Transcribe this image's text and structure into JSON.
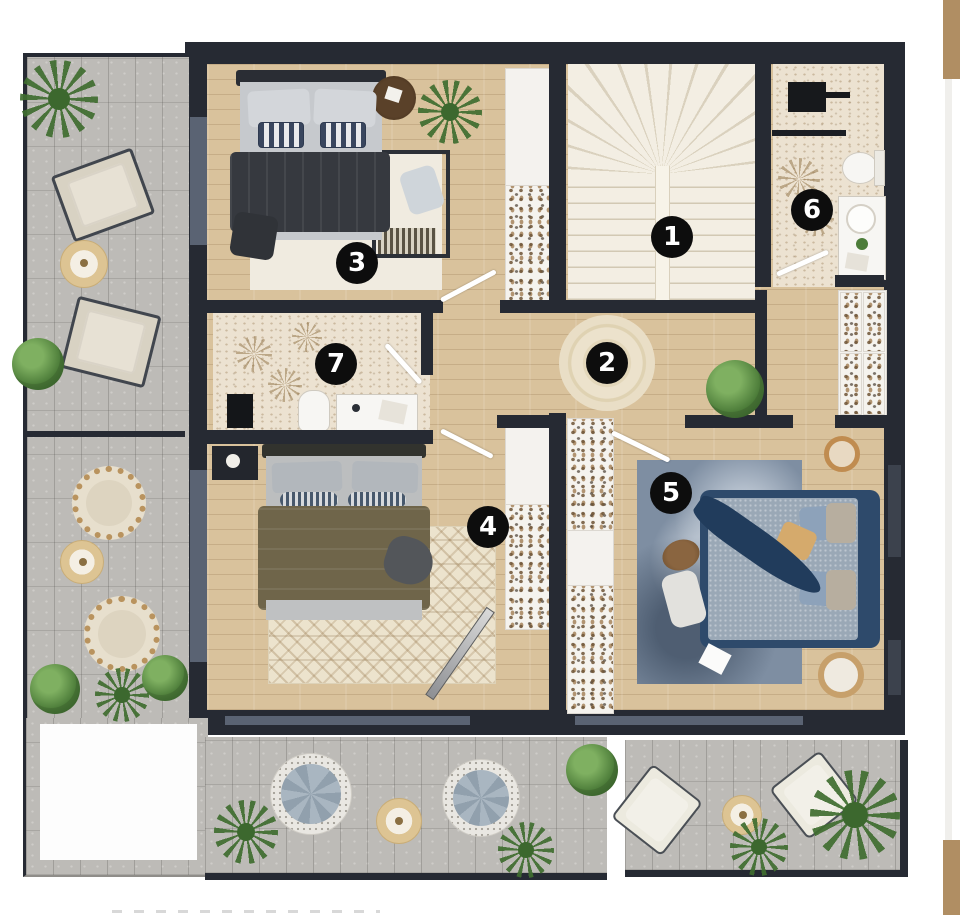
{
  "room_badges": [
    {
      "label": "1"
    },
    {
      "label": "2"
    },
    {
      "label": "3"
    },
    {
      "label": "4"
    },
    {
      "label": "5"
    },
    {
      "label": "6"
    },
    {
      "label": "7"
    }
  ],
  "theme": {
    "wall": "#262a33",
    "wood": "#d9c29c",
    "terrace": "#bdbbb7",
    "stairs": "#f3eee3",
    "bath_floor": "#ece2d1",
    "glazing": "#5a6373",
    "badge_bg": "#0d0d0d",
    "badge_text": "#ffffff",
    "tan_block": "#b08e63",
    "plant_green": "#4c7c39"
  }
}
